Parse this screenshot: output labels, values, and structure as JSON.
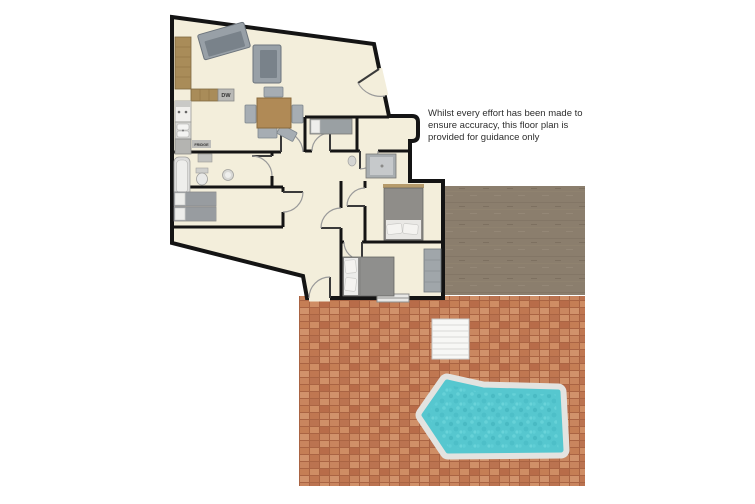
{
  "floor_plan": {
    "disclaimer": "Whilst every effort has been made to ensure accuracy, this floor plan is provided for guidance only",
    "labels": {
      "dishwasher": "DW",
      "fridge": "FRIDGE"
    },
    "features": [
      "open-plan-living-dining-kitchen",
      "entrance-door",
      "single-bedroom",
      "bathroom",
      "shower-room",
      "twin-bedroom",
      "double-bedroom-upper",
      "double-bedroom-lower",
      "wardrobe",
      "hallway",
      "patio-terrace",
      "garden-steps",
      "swimming-pool",
      "ground-area"
    ],
    "colors": {
      "floor": "#f3eedb",
      "wall": "#141414",
      "brick_base": "#c5815b",
      "brick_grout": "#aa6443",
      "ground": "#8b7e6d",
      "pool_water": "#56c7cf",
      "pool_coping": "#e3e3e0",
      "furniture_gray": "#98a0a7",
      "wood": "#ad8c58",
      "steps": "#f7f7f5"
    }
  }
}
